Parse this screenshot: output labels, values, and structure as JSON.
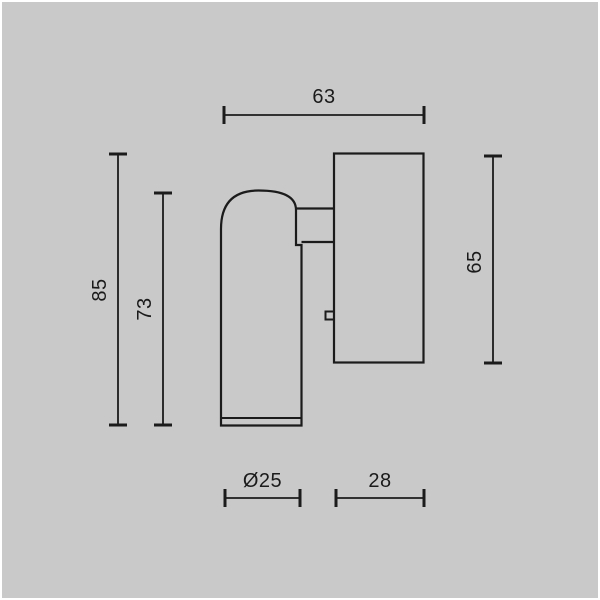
{
  "page": {
    "background_color": "#c9c9c9",
    "frame_color": "#ffffff",
    "ink_color": "#1b1b1b"
  },
  "drawing": {
    "dimensions": {
      "total_width": {
        "label": "63"
      },
      "total_height": {
        "label": "85"
      },
      "fixture_height": {
        "label": "73"
      },
      "base_height": {
        "label": "65"
      },
      "spot_diameter": {
        "label": "Ø25"
      },
      "base_width": {
        "label": "28"
      }
    }
  }
}
